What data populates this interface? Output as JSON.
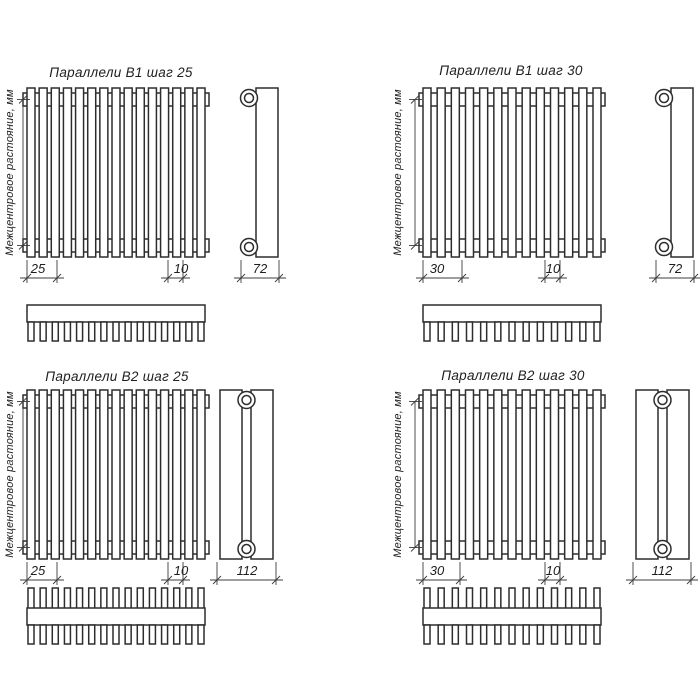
{
  "page": {
    "background": "#ffffff",
    "line_color": "#2d2d2d",
    "text_color": "#1e1e1e"
  },
  "panels": [
    {
      "id": "b1-25",
      "title": "Параллели В1 шаг 25",
      "vertical_label": "Межцентровое растояние, мм",
      "step_dim": "25",
      "tube_dim": "10",
      "depth_dim": "72",
      "tubes": 15,
      "rows": 1
    },
    {
      "id": "b1-30",
      "title": "Параллели В1 шаг 30",
      "vertical_label": "Межцентровое растояние, мм",
      "step_dim": "30",
      "tube_dim": "10",
      "depth_dim": "72",
      "tubes": 13,
      "rows": 1
    },
    {
      "id": "b2-25",
      "title": "Параллели В2 шаг 25",
      "vertical_label": "Межцентровое растояние, мм",
      "step_dim": "25",
      "tube_dim": "10",
      "depth_dim": "112",
      "tubes": 15,
      "rows": 2
    },
    {
      "id": "b2-30",
      "title": "Параллели В2 шаг 30",
      "vertical_label": "Межцентровое растояние, мм",
      "step_dim": "30",
      "tube_dim": "10",
      "depth_dim": "112",
      "tubes": 13,
      "rows": 2
    }
  ]
}
